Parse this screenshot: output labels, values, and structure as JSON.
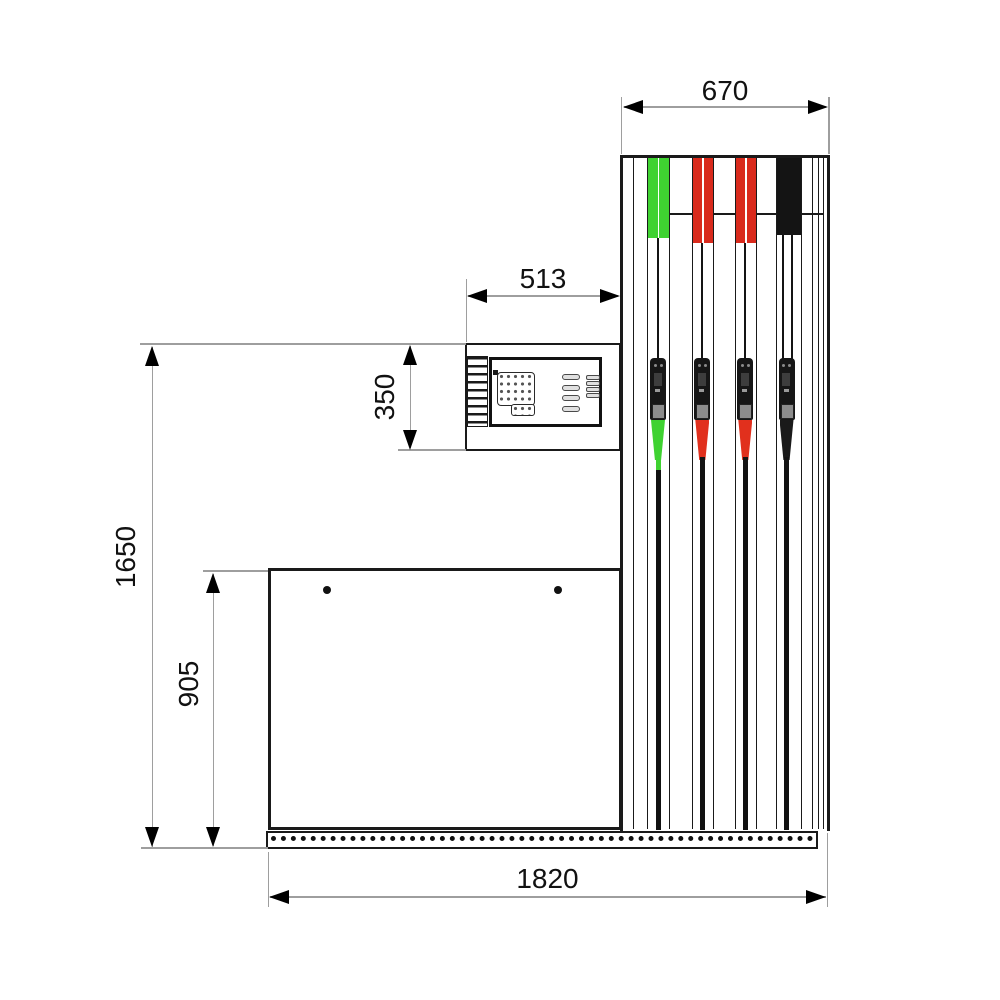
{
  "title": "Fuel dispenser dimensioned outline drawing",
  "units": "mm",
  "dims": {
    "pillar_width": "670",
    "head_width": "513",
    "head_height": "350",
    "overall_height": "1650",
    "cabinet_height": "905",
    "overall_width": "1820"
  },
  "colors": {
    "outline": "#1a1a1a",
    "dimension_line": "#9e9e9e",
    "dimension_text": "#111111",
    "hose_green": "#3fd231",
    "hose_red": "#d92a1c",
    "hose_black": "#141414"
  },
  "stations": [
    {
      "name": "station-1-green",
      "cap_color": "#3fd231",
      "spout_color": "#3fd231",
      "tip_color": "#3fd231"
    },
    {
      "name": "station-2-red",
      "cap_color": "#d92a1c",
      "spout_color": "#e1301d",
      "tip_color": "#141414"
    },
    {
      "name": "station-3-red",
      "cap_color": "#d92a1c",
      "spout_color": "#e1301d",
      "tip_color": "#141414"
    },
    {
      "name": "station-4-black",
      "cap_color": "#141414",
      "spout_color": "#1a1a1a",
      "tip_color": "#141414"
    }
  ]
}
